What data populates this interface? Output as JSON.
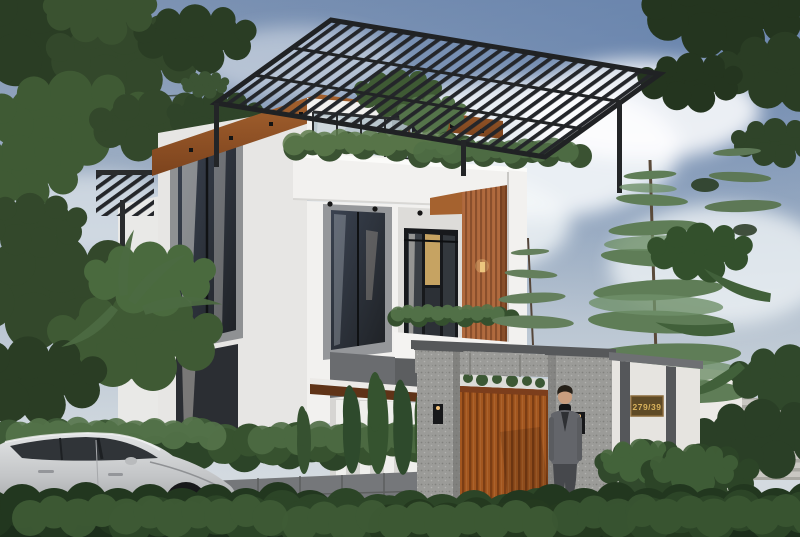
{
  "scene": {
    "type": "architectural-exterior-3d-render",
    "description": "Modern three-storey white house with black rooftop pergola, wood accents, rooftop hedges, granite gate with wooden door, man in suit, silver sedan and landscaped hedges under a cloudy blue sky",
    "house_number": "279/39"
  },
  "palette": {
    "sky_top": "#7d93b3",
    "sky_horizon": "#d8dde2",
    "cloud": "#f4f7f9",
    "wall_white": "#f2f1ef",
    "wall_shade": "#e7e6e4",
    "accent_panel": "#95979a",
    "window_dark": "#24272b",
    "wood_soffit": "#9a5a2c",
    "wood_slat": "#b06a3e",
    "pergola_dark": "#24262a",
    "granite": "#9b9b98",
    "granite_cap": "#56585a",
    "stone_wall": "#75777a",
    "gate_wood": "#a2561f",
    "address_wall": "#e6e4e0",
    "stripe_dark": "#55575a",
    "plaque_bg": "#5e4a26",
    "plaque_text": "#d8b25c",
    "hedge_dark": "#2c4428",
    "hedge_mid": "#3e5a37",
    "hedge_light": "#55744a",
    "foliage_dark": "#2a3d24",
    "foliage_mid": "#3f5a34",
    "foliage_light": "#5d7b4c",
    "conifer": "#5f7d57",
    "cypress": "#2e4a2c",
    "car_silver": "#c6c8ca",
    "car_glass": "#303438",
    "suit": "#63656a",
    "trousers": "#46484c",
    "skin": "#c99e7f",
    "pavement": "#cac9c5"
  }
}
